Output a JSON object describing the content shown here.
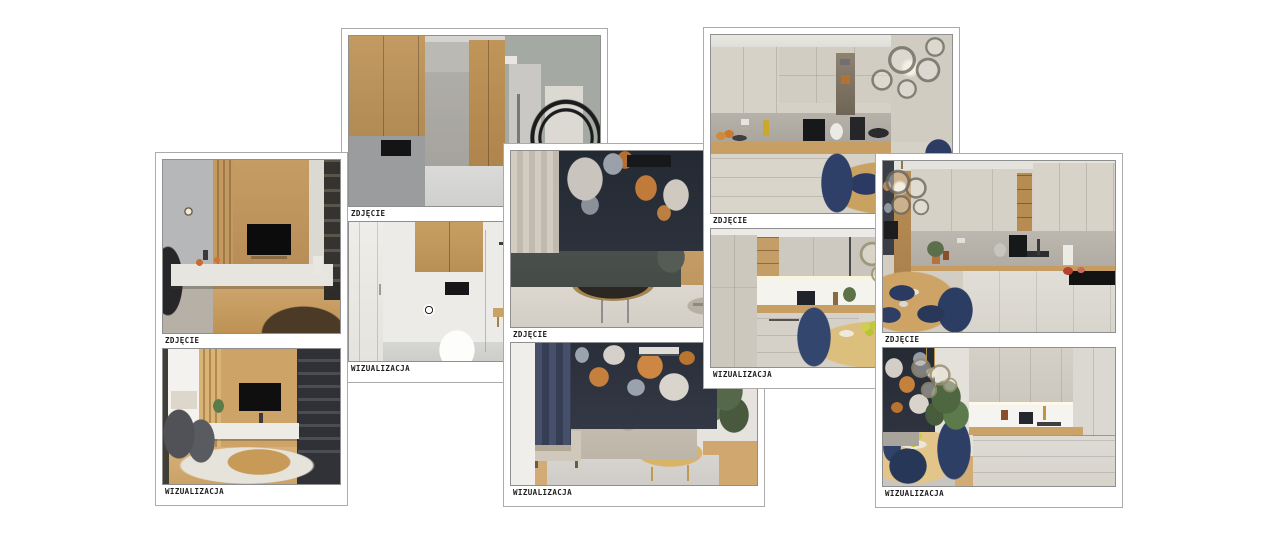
{
  "page": {
    "background_color": "#ffffff"
  },
  "labels": {
    "photo": "ZDJĘCIE",
    "visualization": "WIZUALIZACJA"
  },
  "cards": [
    {
      "name": "living-room",
      "top_label": "ZDJĘCIE",
      "bottom_label": "WIZUALIZACJA",
      "top_image": "living-room-with-tv-photo",
      "bottom_image": "living-room-visualization"
    },
    {
      "name": "hallway-bathroom",
      "top_label": "ZDJĘCIE",
      "bottom_label": "WIZUALIZACJA",
      "top_image": "hallway-wardrobe-photo",
      "bottom_image": "bathroom-visualization"
    },
    {
      "name": "floral-living-room",
      "top_label": "ZDJĘCIE",
      "bottom_label": "WIZUALIZACJA",
      "top_image": "floral-wall-living-room-photo",
      "bottom_image": "floral-wall-living-room-visualization"
    },
    {
      "name": "kitchen-dining",
      "top_label": "ZDJĘCIE",
      "bottom_label": "WIZUALIZACJA",
      "top_image": "kitchen-dining-photo",
      "bottom_image": "kitchen-dining-visualization"
    },
    {
      "name": "kitchen-corner",
      "top_label": "ZDJĘCIE",
      "bottom_label": "WIZUALIZACJA",
      "top_image": "corner-kitchen-photo",
      "bottom_image": "corner-kitchen-visualization"
    }
  ],
  "palette": {
    "card_border": "#ababab",
    "photo_border": "#8f8f8f",
    "label_text": "#1c1c1c",
    "wood": "#c49a63",
    "navy_chair": "#2c3e66",
    "floral_wall": "#2a2f3a"
  }
}
